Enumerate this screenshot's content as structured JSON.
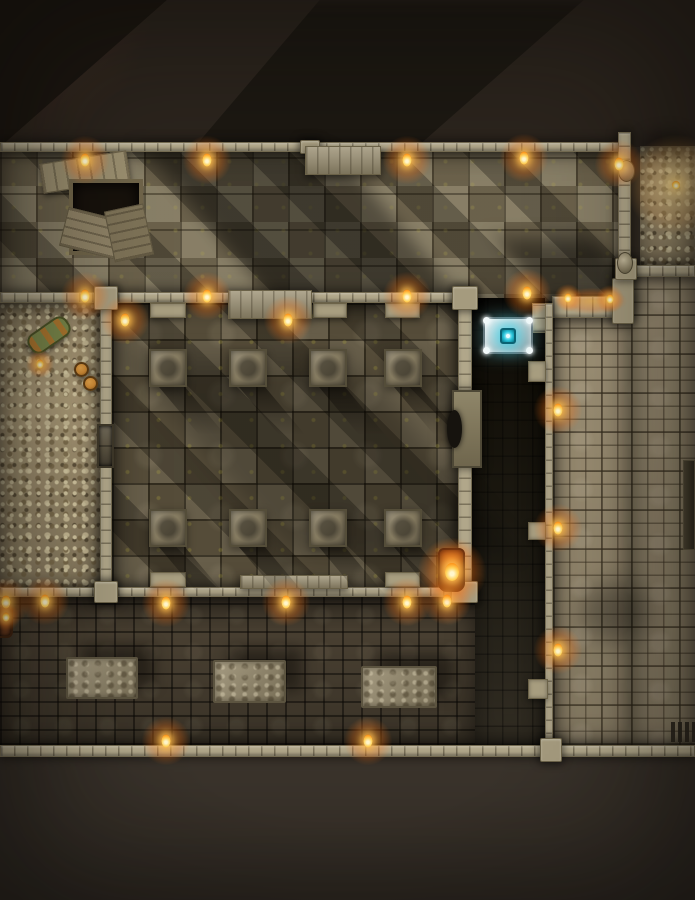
{
  "scene": {
    "type": "top-down-dungeon-battle-map",
    "grid_visible": false,
    "colors": {
      "offmap_top": "#2b241d",
      "offmap_bottom": "#3b342c",
      "wall": "#b1a78a",
      "hall_floor": "#7b7058",
      "pillar_hall_floor": "#5f5540",
      "bones": "#b2a17d",
      "dark_passage": "#131009",
      "south_hall_floor": "#483f31",
      "tile_corridor": "#9a8d72",
      "torch_flame": "#ffd45e",
      "torch_glow": "#ff9b2a",
      "altar_base": "#dde6e8",
      "altar_gem": "#2ec8de",
      "moss": "#a89b3e"
    },
    "rooms": [
      {
        "name": "great-hall",
        "kind": "hall",
        "x": 0,
        "y": 150,
        "w": 631,
        "h": 153
      },
      {
        "name": "bone-niche-northeast",
        "kind": "bones",
        "x": 640,
        "y": 146,
        "w": 55,
        "h": 123
      },
      {
        "name": "bone-pit-west",
        "kind": "bones",
        "x": 0,
        "y": 303,
        "w": 100,
        "h": 290
      },
      {
        "name": "pillar-hall",
        "kind": "pillarhall",
        "x": 112,
        "y": 303,
        "w": 346,
        "h": 290
      },
      {
        "name": "dark-passage",
        "kind": "dark",
        "x": 472,
        "y": 298,
        "w": 73,
        "h": 447
      },
      {
        "name": "south-hall",
        "kind": "southhall",
        "x": 0,
        "y": 597,
        "w": 475,
        "h": 148
      },
      {
        "name": "east-corridor-upper",
        "kind": "tiles",
        "x": 631,
        "y": 275,
        "w": 64,
        "h": 470
      },
      {
        "name": "east-corridor",
        "kind": "tiles",
        "x": 553,
        "y": 318,
        "w": 78,
        "h": 427
      }
    ],
    "walls": [
      {
        "name": "north-wall",
        "kind": "wall-h",
        "x": 0,
        "y": 142,
        "w": 621,
        "h": 10
      },
      {
        "name": "mid-wall",
        "kind": "wall-h",
        "x": 0,
        "y": 292,
        "w": 472,
        "h": 11
      },
      {
        "name": "ember-wall",
        "kind": "wall-h",
        "x": 552,
        "y": 296,
        "w": 80,
        "h": 22
      },
      {
        "name": "nook-east-stub",
        "kind": "wall-v",
        "x": 532,
        "y": 303,
        "w": 20,
        "h": 30
      },
      {
        "name": "northeast-wall",
        "kind": "wall-v",
        "x": 618,
        "y": 132,
        "w": 13,
        "h": 146
      },
      {
        "name": "bone-niche-south-wall",
        "kind": "wall-h",
        "x": 622,
        "y": 265,
        "w": 73,
        "h": 12
      },
      {
        "name": "bone-pit-east-wall",
        "kind": "wall-v",
        "x": 100,
        "y": 292,
        "w": 12,
        "h": 305
      },
      {
        "name": "pillar-hall-east-wall",
        "kind": "wall-v",
        "x": 458,
        "y": 292,
        "w": 14,
        "h": 305
      },
      {
        "name": "dark-passage-east-wall",
        "kind": "wall-v",
        "x": 545,
        "y": 303,
        "w": 8,
        "h": 445
      },
      {
        "name": "south-hall-north-wall",
        "kind": "wall-h",
        "x": 0,
        "y": 587,
        "w": 475,
        "h": 10
      },
      {
        "name": "south-wall",
        "kind": "wall-h",
        "x": 0,
        "y": 745,
        "w": 695,
        "h": 12
      },
      {
        "name": "joint-west-mid",
        "kind": "joint",
        "x": 94,
        "y": 286,
        "w": 24,
        "h": 24
      },
      {
        "name": "joint-east-mid",
        "kind": "joint",
        "x": 452,
        "y": 286,
        "w": 26,
        "h": 24
      },
      {
        "name": "joint-west-south",
        "kind": "joint",
        "x": 94,
        "y": 581,
        "w": 24,
        "h": 22
      },
      {
        "name": "joint-east-south",
        "kind": "joint",
        "x": 451,
        "y": 581,
        "w": 27,
        "h": 22
      },
      {
        "name": "joint-corridor-top",
        "kind": "joint",
        "x": 612,
        "y": 278,
        "w": 22,
        "h": 46
      },
      {
        "name": "joint-niche-corner",
        "kind": "joint",
        "x": 615,
        "y": 258,
        "w": 22,
        "h": 22
      },
      {
        "name": "joint-south-east",
        "kind": "joint",
        "x": 540,
        "y": 738,
        "w": 22,
        "h": 24
      },
      {
        "name": "joint-north-center",
        "kind": "joint",
        "x": 300,
        "y": 140,
        "w": 20,
        "h": 14
      },
      {
        "name": "wall-stub-north-1",
        "kind": "stub",
        "x": 150,
        "y": 303,
        "w": 36,
        "h": 15
      },
      {
        "name": "wall-stub-north-2",
        "kind": "stub",
        "x": 313,
        "y": 303,
        "w": 34,
        "h": 15
      },
      {
        "name": "wall-stub-north-3",
        "kind": "stub",
        "x": 385,
        "y": 303,
        "w": 35,
        "h": 15
      },
      {
        "name": "wall-stub-south-1",
        "kind": "stub",
        "x": 150,
        "y": 572,
        "w": 36,
        "h": 15
      },
      {
        "name": "wall-stub-south-2",
        "kind": "stub",
        "x": 385,
        "y": 572,
        "w": 35,
        "h": 15
      },
      {
        "name": "dark-passage-stub-1",
        "kind": "stub",
        "x": 528,
        "y": 361,
        "w": 18,
        "h": 21
      },
      {
        "name": "dark-passage-stub-2",
        "kind": "stub",
        "x": 528,
        "y": 522,
        "w": 18,
        "h": 18
      },
      {
        "name": "east-door-block",
        "kind": "stub",
        "x": 528,
        "y": 679,
        "w": 20,
        "h": 20
      }
    ],
    "shades": [
      {
        "name": "great-hall-shadow",
        "x": 210,
        "y": 150,
        "w": 190,
        "h": 152,
        "skew": 40,
        "op": 0.38,
        "blur": 10
      },
      {
        "name": "hall-corner-shadow",
        "x": 520,
        "y": 238,
        "w": 100,
        "h": 64,
        "skew": 35,
        "op": 0.45,
        "blur": 10
      },
      {
        "name": "pillar-hall-shadow",
        "x": 210,
        "y": 360,
        "w": 230,
        "h": 200,
        "skew": 40,
        "op": 0.22,
        "blur": 14
      },
      {
        "name": "corridor-shadow",
        "x": 580,
        "y": 582,
        "w": 70,
        "h": 60,
        "skew": 0,
        "op": 0.3,
        "blur": 12
      },
      {
        "name": "bone-niche-shadow",
        "x": 640,
        "y": 132,
        "w": 55,
        "h": 26,
        "skew": 0,
        "op": 0.4,
        "blur": 8
      }
    ],
    "objects": [
      {
        "name": "collapsed-trapdoor",
        "kind": "trapdoor",
        "x": 55,
        "y": 163,
        "w": 98,
        "h": 102,
        "inter": false
      },
      {
        "name": "north-dais",
        "kind": "dais",
        "x": 305,
        "y": 146,
        "w": 76,
        "h": 29,
        "inter": false
      },
      {
        "name": "pillar-hall-north-dais",
        "kind": "dais",
        "x": 228,
        "y": 290,
        "w": 84,
        "h": 29,
        "inter": false
      },
      {
        "name": "pillar-hall-south-dais",
        "kind": "dais",
        "x": 240,
        "y": 575,
        "w": 108,
        "h": 14,
        "inter": false
      },
      {
        "name": "pillar-1",
        "kind": "pillar",
        "x": 149,
        "y": 349,
        "w": 38,
        "h": 38,
        "inter": false
      },
      {
        "name": "pillar-2",
        "kind": "pillar",
        "x": 229,
        "y": 349,
        "w": 38,
        "h": 38,
        "inter": false
      },
      {
        "name": "pillar-3",
        "kind": "pillar",
        "x": 309,
        "y": 349,
        "w": 38,
        "h": 38,
        "inter": false
      },
      {
        "name": "pillar-4",
        "kind": "pillar",
        "x": 384,
        "y": 349,
        "w": 38,
        "h": 38,
        "inter": false
      },
      {
        "name": "pillar-5",
        "kind": "pillar",
        "x": 149,
        "y": 509,
        "w": 38,
        "h": 38,
        "inter": false
      },
      {
        "name": "pillar-6",
        "kind": "pillar",
        "x": 229,
        "y": 509,
        "w": 38,
        "h": 38,
        "inter": false
      },
      {
        "name": "pillar-7",
        "kind": "pillar",
        "x": 309,
        "y": 509,
        "w": 38,
        "h": 38,
        "inter": false
      },
      {
        "name": "pillar-8",
        "kind": "pillar",
        "x": 384,
        "y": 509,
        "w": 38,
        "h": 38,
        "inter": false
      },
      {
        "name": "sarcophagus-slab",
        "kind": "slab",
        "x": 452,
        "y": 390,
        "w": 30,
        "h": 78,
        "inter": false
      },
      {
        "name": "glowing-altar",
        "kind": "altar",
        "x": 483,
        "y": 317,
        "w": 50,
        "h": 37,
        "inter": true
      },
      {
        "name": "bone-pit-door",
        "kind": "door",
        "x": 97,
        "y": 424,
        "w": 17,
        "h": 44,
        "inter": true
      },
      {
        "name": "green-barrel",
        "kind": "barrel-green",
        "x": 30,
        "y": 314,
        "w": 50,
        "h": 44,
        "inter": false
      },
      {
        "name": "supply-barrels",
        "kind": "barrels-orange",
        "x": 72,
        "y": 362,
        "w": 32,
        "h": 36,
        "inter": false
      },
      {
        "name": "burning-barrel",
        "kind": "barrel-fire",
        "x": 438,
        "y": 548,
        "w": 27,
        "h": 44,
        "inter": false
      },
      {
        "name": "west-brazier",
        "kind": "brazier",
        "x": 0,
        "y": 605,
        "w": 13,
        "h": 33,
        "inter": false
      },
      {
        "name": "stone-table-1",
        "kind": "table",
        "x": 66,
        "y": 657,
        "w": 72,
        "h": 42,
        "inter": false
      },
      {
        "name": "stone-table-2",
        "kind": "table",
        "x": 213,
        "y": 660,
        "w": 73,
        "h": 43,
        "inter": false
      },
      {
        "name": "stone-table-3",
        "kind": "table",
        "x": 361,
        "y": 666,
        "w": 76,
        "h": 42,
        "inter": false
      },
      {
        "name": "floor-grate",
        "kind": "grate",
        "x": 671,
        "y": 722,
        "w": 24,
        "h": 20,
        "inter": false
      },
      {
        "name": "wall-channel",
        "kind": "channel",
        "x": 683,
        "y": 460,
        "w": 12,
        "h": 90,
        "inter": false
      },
      {
        "name": "wall-sconce-1",
        "kind": "sconce",
        "x": 618,
        "y": 160,
        "w": 17,
        "h": 22,
        "inter": false
      },
      {
        "name": "wall-sconce-2",
        "kind": "sconce",
        "x": 617,
        "y": 252,
        "w": 16,
        "h": 22,
        "inter": false
      }
    ],
    "lights": [
      {
        "kind": "torch",
        "x": 85,
        "y": 160
      },
      {
        "kind": "torch",
        "x": 207,
        "y": 160
      },
      {
        "kind": "torch",
        "x": 407,
        "y": 160
      },
      {
        "kind": "torch",
        "x": 524,
        "y": 158
      },
      {
        "kind": "torch",
        "x": 619,
        "y": 164
      },
      {
        "kind": "bone-glow",
        "x": 676,
        "y": 185
      },
      {
        "kind": "torch",
        "x": 85,
        "y": 296
      },
      {
        "kind": "torch",
        "x": 207,
        "y": 296
      },
      {
        "kind": "torch",
        "x": 407,
        "y": 296
      },
      {
        "kind": "torch",
        "x": 527,
        "y": 293
      },
      {
        "kind": "ember",
        "x": 592,
        "y": 301
      },
      {
        "kind": "candle",
        "x": 568,
        "y": 298
      },
      {
        "kind": "candle",
        "x": 610,
        "y": 299
      },
      {
        "kind": "torch",
        "x": 125,
        "y": 320
      },
      {
        "kind": "torch",
        "x": 288,
        "y": 320
      },
      {
        "kind": "candle",
        "x": 40,
        "y": 364
      },
      {
        "kind": "torch",
        "x": 558,
        "y": 410
      },
      {
        "kind": "torch",
        "x": 558,
        "y": 528
      },
      {
        "kind": "torch",
        "x": 558,
        "y": 650
      },
      {
        "kind": "torch",
        "x": 6,
        "y": 602
      },
      {
        "kind": "torch",
        "x": 45,
        "y": 601
      },
      {
        "kind": "torch",
        "x": 166,
        "y": 603
      },
      {
        "kind": "torch",
        "x": 286,
        "y": 602
      },
      {
        "kind": "torch",
        "x": 407,
        "y": 602
      },
      {
        "kind": "torch",
        "x": 447,
        "y": 601
      },
      {
        "kind": "flame",
        "x": 452,
        "y": 572
      },
      {
        "kind": "candle",
        "x": 6,
        "y": 617
      },
      {
        "kind": "torch",
        "x": 166,
        "y": 741
      },
      {
        "kind": "torch",
        "x": 368,
        "y": 741
      }
    ]
  }
}
